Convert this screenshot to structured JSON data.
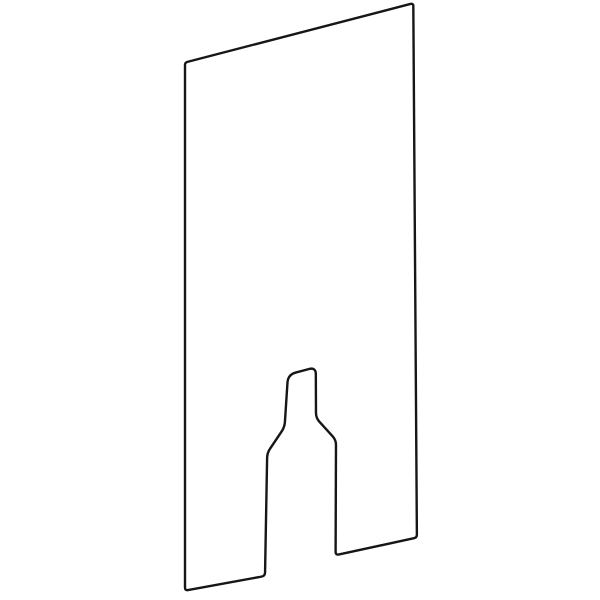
{
  "canvas": {
    "width": 600,
    "height": 600,
    "background": "#ffffff"
  },
  "drawing": {
    "description": "technical-line-drawing-of-rectangular-front-panel-in-perspective-with-bottle-shaped-cutout-at-bottom-edge",
    "stroke_color": "#161616",
    "stroke_width": 2.4,
    "fill_color": "#ffffff",
    "outline": [
      {
        "name": "panel-top-left",
        "x": 185.0,
        "y": 62.5,
        "r": 2.5
      },
      {
        "name": "panel-top-right",
        "x": 413.3,
        "y": 3.2,
        "r": 3.0
      },
      {
        "name": "panel-bottom-right",
        "x": 416.9,
        "y": 537.6,
        "r": 3.0
      },
      {
        "name": "cutout-bottom-right",
        "x": 335.6,
        "y": 555.2,
        "r": 3.5
      },
      {
        "name": "cutout-right-shoulder-low",
        "x": 336.0,
        "y": 440.0,
        "r": 5.0
      },
      {
        "name": "cutout-right-shoulder-top",
        "x": 316.0,
        "y": 418.0,
        "r": 5.0
      },
      {
        "name": "cutout-neck-top-right",
        "x": 315.8,
        "y": 367.2,
        "r": 7.0
      },
      {
        "name": "cutout-neck-top-left",
        "x": 288.0,
        "y": 374.6,
        "r": 8.0
      },
      {
        "name": "cutout-left-shoulder-top",
        "x": 284.6,
        "y": 427.0,
        "r": 5.0
      },
      {
        "name": "cutout-left-shoulder-low",
        "x": 267.2,
        "y": 453.0,
        "r": 5.0
      },
      {
        "name": "cutout-bottom-left",
        "x": 265.0,
        "y": 576.0,
        "r": 3.5
      },
      {
        "name": "panel-bottom-left",
        "x": 185.0,
        "y": 590.6,
        "r": 3.0
      }
    ]
  }
}
